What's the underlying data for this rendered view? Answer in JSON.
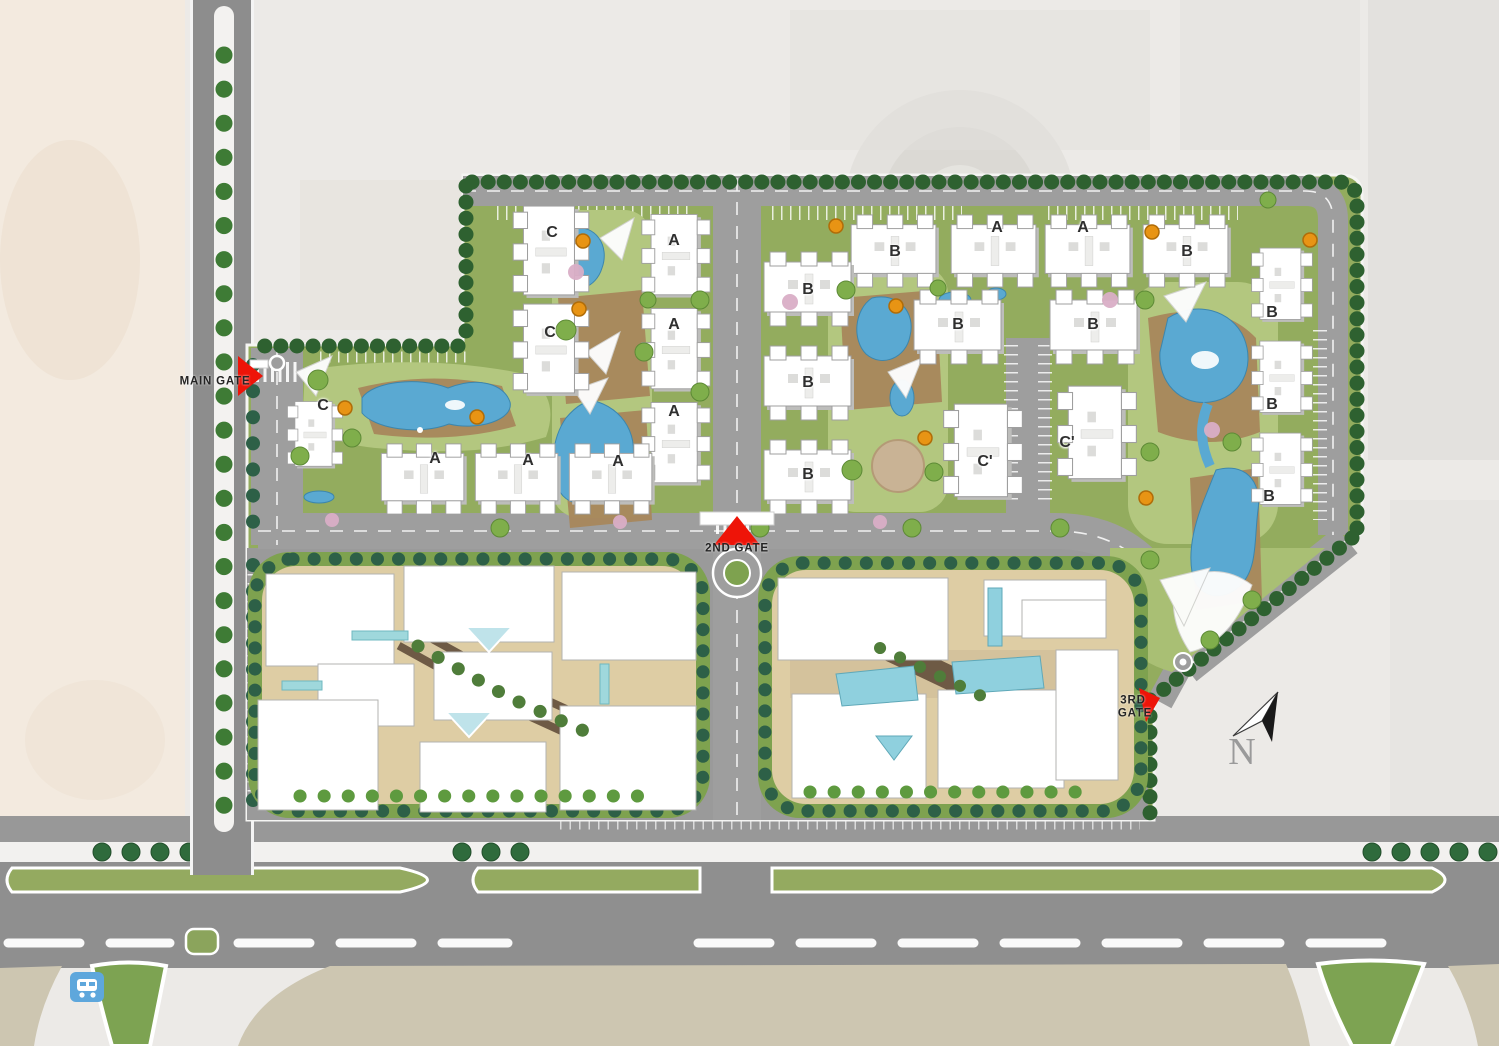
{
  "map_title": "Residential compound master plan (aerial site map)",
  "gates": {
    "main": {
      "label": "MAIN GATE"
    },
    "second": {
      "label": "2ND GATE"
    },
    "third": {
      "line1": "3RD",
      "line2": "GATE"
    }
  },
  "compass": {
    "label": "N"
  },
  "buildings": [
    {
      "label": "C"
    },
    {
      "label": "C"
    },
    {
      "label": "C"
    },
    {
      "label": "A"
    },
    {
      "label": "A"
    },
    {
      "label": "A"
    },
    {
      "label": "A"
    },
    {
      "label": "A"
    },
    {
      "label": "A"
    },
    {
      "label": "B"
    },
    {
      "label": "A"
    },
    {
      "label": "A"
    },
    {
      "label": "B"
    },
    {
      "label": "B"
    },
    {
      "label": "B"
    },
    {
      "label": "B"
    },
    {
      "label": "B"
    },
    {
      "label": "B"
    },
    {
      "label": "C'"
    },
    {
      "label": "C'"
    },
    {
      "label": "B"
    },
    {
      "label": "B"
    },
    {
      "label": "B"
    }
  ],
  "building_types_present": [
    "A",
    "B",
    "C",
    "C'"
  ],
  "icons": {
    "main_gate_marker": "red-triangle-marker",
    "second_gate_marker": "red-triangle-marker",
    "third_gate_marker": "red-triangle-marker",
    "north_arrow": "north-compass-arrow",
    "bus_stop": "bus-stop-sign"
  },
  "colors": {
    "lawn": "#93ac5e",
    "amenity_lawn": "#b3c77f",
    "road": "#9e9e9e",
    "highway": "#8f8f8f",
    "pool_water": "#5aa9d2",
    "shallow_water": "#9fd8dc",
    "wood_deck": "#a8875c",
    "plaza": "#decda4",
    "walkway_brown": "#6e5a45",
    "hedge": "#2e6130",
    "palm": "#2d6047",
    "building_white": "#ffffff",
    "gate_marker_red": "#ee1408",
    "desert_background": "#f3eadf",
    "satellite_background": "#eceae7",
    "bottom_terrain": "#cdc6b1",
    "bus_stop_blue": "#5ea7dc",
    "umbrella_orange": "#e89414"
  }
}
